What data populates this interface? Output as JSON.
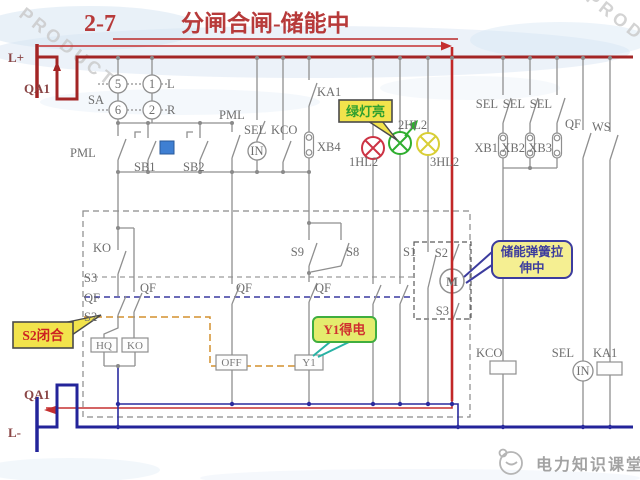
{
  "title": {
    "number": "2-7",
    "text": "分闸合闸-储能中"
  },
  "labels": {
    "l_plus": "L+",
    "l_minus": "L-",
    "qa1": "QA1",
    "sa": "SA",
    "n5": "5",
    "n1": "1",
    "n6": "6",
    "n2": "2",
    "l": "L",
    "r": "R",
    "pml": "PML",
    "sb1": "SB1",
    "sb2": "SB2",
    "sel": "SEL",
    "kco": "KCO",
    "in": "IN",
    "ka1": "KA1",
    "xb4": "XB4",
    "hl1": "1HL2",
    "hl2": "2HL2",
    "hl3": "3HL2",
    "xb1": "XB1",
    "xb2": "XB2",
    "xb3": "XB3",
    "qf": "QF",
    "ws": "WS",
    "ko": "KO",
    "s1": "S1",
    "s2": "S2",
    "s3": "S3",
    "s8": "S8",
    "s9": "S9",
    "m": "M",
    "hq": "HQ",
    "off": "OFF",
    "y1": "Y1"
  },
  "callouts": {
    "green_lamp_on": "绿灯亮",
    "s2_closed": "S2闭合",
    "y1_energized": "Y1得电",
    "spring_charging_line1": "储能弹簧拉",
    "spring_charging_line2": "伸中"
  },
  "watermark": {
    "brand": "电力知识课堂",
    "background": "PRODUCT"
  },
  "colors": {
    "title_red": "#b73a3a",
    "bus_red": "#a32525",
    "path_red": "#c22727",
    "navy": "#23249a",
    "wire_gray": "#8f8f8f",
    "callout_yellow": "#f2e34c",
    "callout_green_border": "#3fae3f",
    "lamp_red": "#cc3344",
    "lamp_green": "#2fae2f",
    "lamp_yellow": "#d8ce36",
    "link_orange": "#d4902e",
    "blue_square": "#3f7fd2"
  }
}
